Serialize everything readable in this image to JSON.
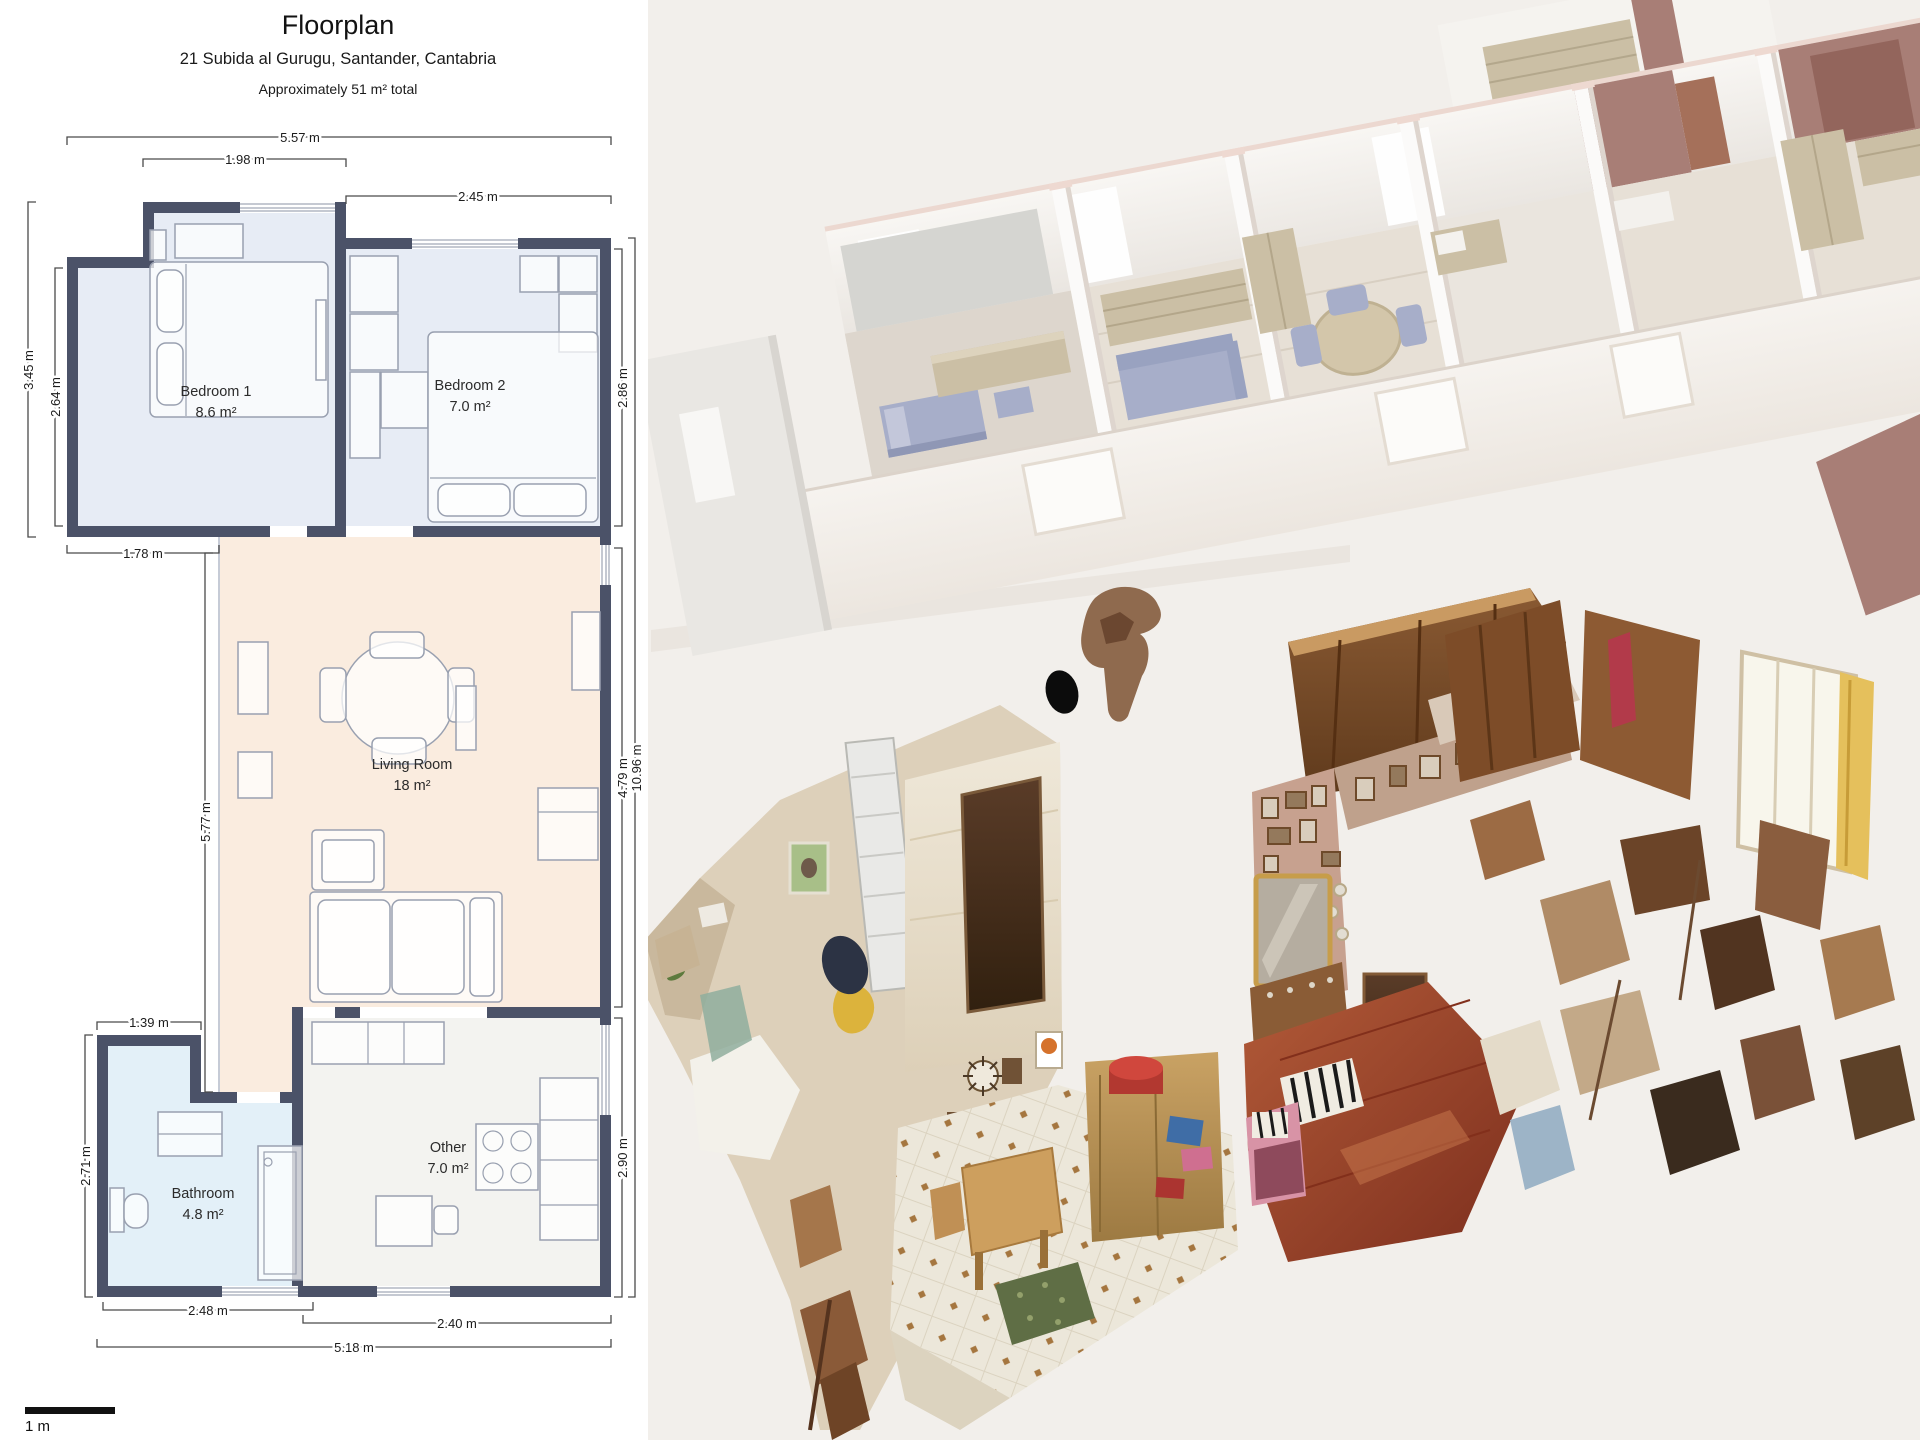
{
  "header": {
    "title": "Floorplan",
    "address": "21 Subida al Gurugu, Santander, Cantabria",
    "total_area": "Approximately 51 m² total"
  },
  "floorplan": {
    "scale_label": "1 m",
    "rooms": [
      {
        "name": "Bedroom 1",
        "area": "8.6 m²"
      },
      {
        "name": "Bedroom 2",
        "area": "7.0 m²"
      },
      {
        "name": "Living Room",
        "area": "18 m²"
      },
      {
        "name": "Bathroom",
        "area": "4.8 m²"
      },
      {
        "name": "Other",
        "area": "7.0 m²"
      }
    ],
    "dimensions": {
      "top_total": "5.57 m",
      "bedroom1_top": "1.98 m",
      "bedroom2_top": "2.45 m",
      "left_outer": "3.45 m",
      "left_inner": "2.64 m",
      "below_bedroom1": "1.78 m",
      "corridor": "5.77 m",
      "bathroom_top": "1.39 m",
      "bathroom_left": "2.71 m",
      "bathroom_bottom": "2.48 m",
      "other_bottom": "2.40 m",
      "bottom_total": "5.18 m",
      "bedroom2_right": "2.86 m",
      "living_right": "4.79 m",
      "other_right": "2.90 m",
      "right_total": "10.96 m"
    }
  },
  "colors": {
    "wall": "#4b5268",
    "bedroom_fill": "#e7ecf5",
    "living_fill": "#faecdf",
    "bathroom_fill": "#e3f0f8",
    "other_fill": "#f3f3f0",
    "render_wall_accent": "#a87e76",
    "render_furniture_tan": "#cbbfa5",
    "render_furniture_blue": "#a7aec9",
    "scan_wood_floor": "#a04a2c",
    "scan_tile_floor": "#ece7da"
  }
}
